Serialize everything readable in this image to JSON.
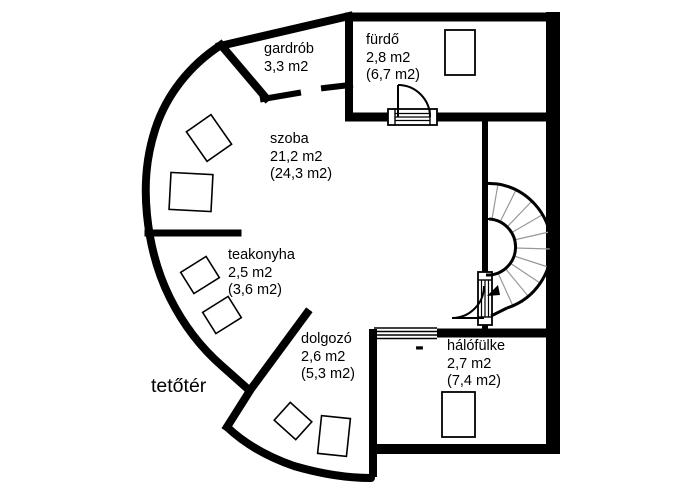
{
  "plan": {
    "floor_label": "tetőtér",
    "wall_color": "#000000",
    "background": "#ffffff",
    "stair_tread_color": "#999999"
  },
  "rooms": [
    {
      "id": "gardrob",
      "name": "gardrób",
      "area": "3,3 m2",
      "area_gross": ""
    },
    {
      "id": "furdo",
      "name": "fürdő",
      "area": "2,8 m2",
      "area_gross": "(6,7 m2)"
    },
    {
      "id": "szoba",
      "name": "szoba",
      "area": "21,2 m2",
      "area_gross": "(24,3 m2)"
    },
    {
      "id": "teakonyha",
      "name": "teakonyha",
      "area": "2,5 m2",
      "area_gross": "(3,6 m2)"
    },
    {
      "id": "dolgozo",
      "name": "dolgozó",
      "area": "2,6 m2",
      "area_gross": "(5,3 m2)"
    },
    {
      "id": "halofulke",
      "name": "hálófülke",
      "area": "2,7 m2",
      "area_gross": "(7,4 m2)"
    }
  ],
  "symbols": {
    "window_dash": "-"
  }
}
